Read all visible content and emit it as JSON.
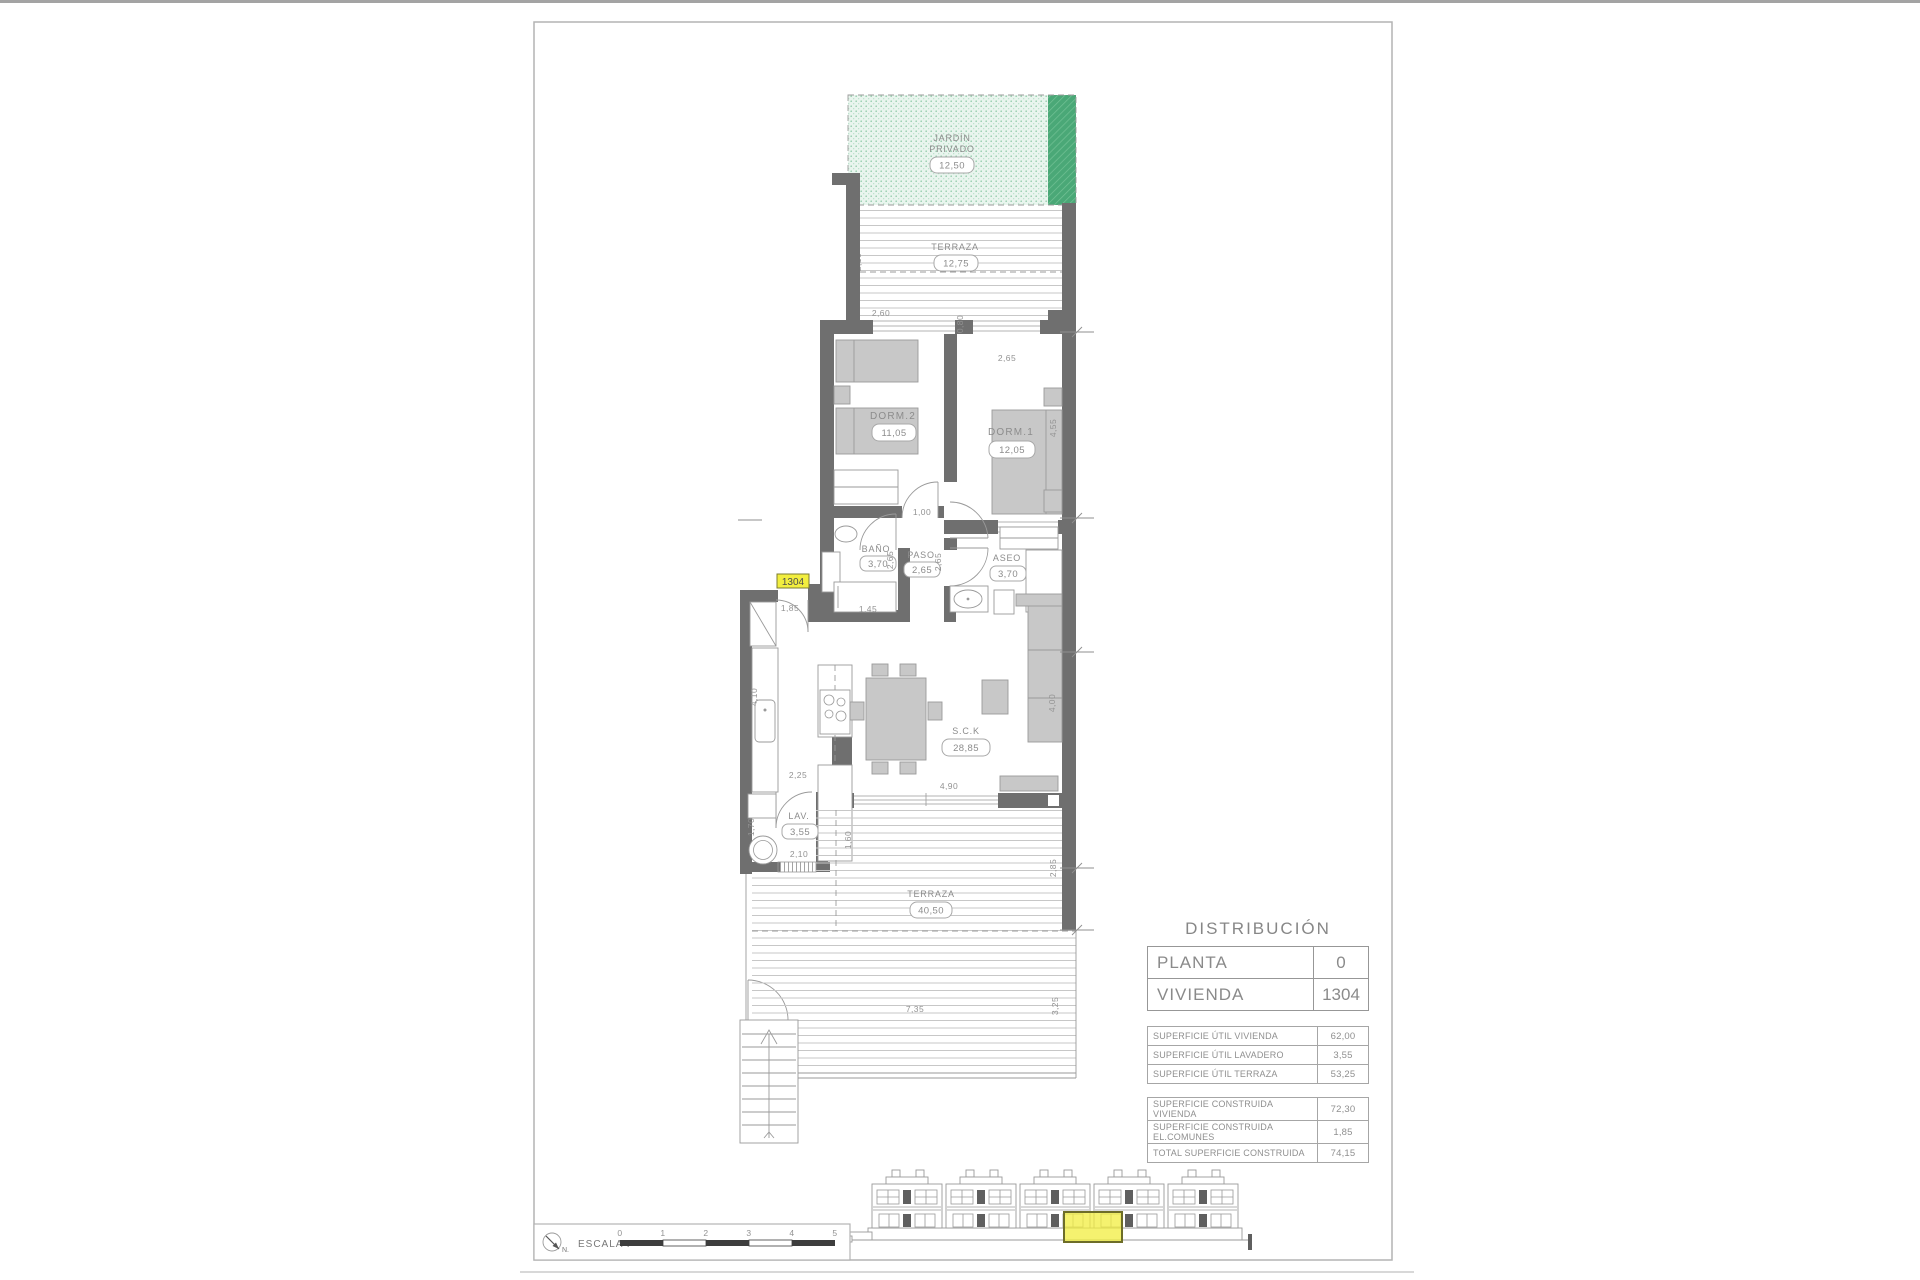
{
  "plan": {
    "unit_tag": "1304",
    "rooms": {
      "jardin_line1": "JARDÍN",
      "jardin_line2": "PRIVADO",
      "jardin_area": "12,50",
      "terraza_top": "TERRAZA",
      "terraza_top_area": "12,75",
      "dorm2": "DORM.2",
      "dorm2_area": "11,05",
      "dorm1": "DORM.1",
      "dorm1_area": "12,05",
      "bano": "BAÑO",
      "bano_area": "3,70",
      "paso": "PASO",
      "paso_area": "2,65",
      "aseo": "ASEO",
      "aseo_area": "3,70",
      "sck": "S.C.K",
      "sck_area": "28,85",
      "lav": "LAV.",
      "lav_area": "3,55",
      "terraza_bottom": "TERRAZA",
      "terraza_bottom_area": "40,50"
    },
    "dims": {
      "terraza_top_depth": "2,10",
      "dorm2_window": "2,60",
      "hall_gap": "0,80",
      "dorm1_window": "2,65",
      "dorm1_depth": "4,55",
      "hall_width": "1,00",
      "bano_depth": "2,65",
      "paso_depth": "2,65",
      "tub_length": "1,45",
      "entry_width": "1,85",
      "kitchen_depth": "4,10",
      "lav_door": "2,25",
      "lav_depth": "1,70",
      "lav_width": "2,10",
      "terraza_cover": "1,60",
      "living_window": "4,90",
      "living_depth": "4,00",
      "terraza_right": "2,85",
      "terraza_width": "7,35",
      "terraza_depth": "3,25"
    }
  },
  "distribution": {
    "title": "DISTRIBUCIÓN",
    "planta_label": "PLANTA",
    "planta_value": "0",
    "vivienda_label": "VIVIENDA",
    "vivienda_value": "1304",
    "util_rows": [
      {
        "label": "SUPERFICIE ÚTIL VIVIENDA",
        "value": "62,00"
      },
      {
        "label": "SUPERFICIE ÚTIL LAVADERO",
        "value": "3,55"
      },
      {
        "label": "SUPERFICIE ÚTIL TERRAZA",
        "value": "53,25"
      }
    ],
    "built_rows": [
      {
        "label": "SUPERFICIE CONSTRUIDA VIVIENDA",
        "value": "72,30"
      },
      {
        "label": "SUPERFICIE CONSTRUIDA EL.COMUNES",
        "value": "1,85"
      },
      {
        "label": "TOTAL SUPERFICIE CONSTRUIDA",
        "value": "74,15"
      }
    ]
  },
  "scale_bar": {
    "label": "ESCALA :",
    "north": "N.",
    "ticks": [
      "0",
      "1",
      "2",
      "3",
      "4",
      "5"
    ]
  },
  "colors": {
    "wall": "#6f6f6f",
    "garden_light": "#e9f5ee",
    "garden_dark": "#4aa877",
    "highlight_yellow": "#f2ee3f"
  }
}
